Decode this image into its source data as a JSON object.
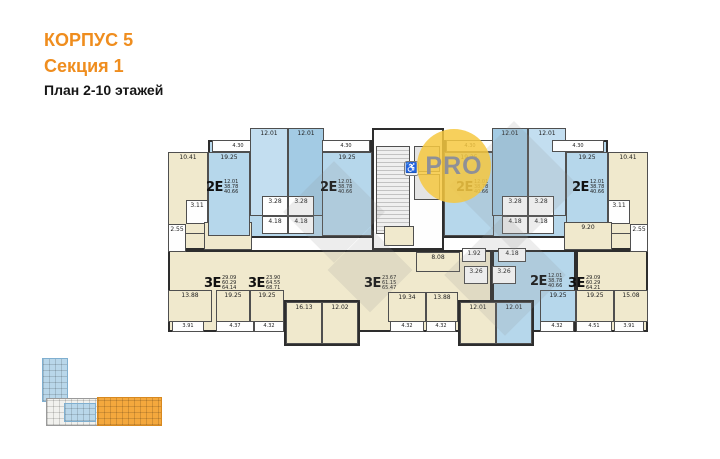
{
  "header": {
    "building": "КОРПУС 5",
    "section": "Секция 1",
    "floor_range": "План 2-10 этажей"
  },
  "badge": {
    "label": "PRO"
  },
  "colors": {
    "accent_orange": "#ef8d1e",
    "title_black": "#161616",
    "apartment_blue": "#b6d7eb",
    "apartment_blue_dark": "#a3cbe4",
    "apartment_beige": "#f0e9cd",
    "wall": "#2d2d2d",
    "badge_yellow": "#f6c83f",
    "badge_text": "#8f9097",
    "minimap_orange": "#f4a83d",
    "minimap_blue": "#b9d7ea"
  },
  "floorplan": {
    "icons": {
      "wheelchair": "♿"
    },
    "apartments": [
      {
        "type": "2Е",
        "areas": [
          "12.01",
          "38.78",
          "40.66"
        ],
        "x": 206,
        "y": 180
      },
      {
        "type": "2Е",
        "areas": [
          "12.01",
          "38.78",
          "40.66"
        ],
        "x": 320,
        "y": 180
      },
      {
        "type": "2Е",
        "areas": [
          "12.01",
          "38.78",
          "40.66"
        ],
        "x": 456,
        "y": 180
      },
      {
        "type": "2Е",
        "areas": [
          "12.01",
          "38.78",
          "40.66"
        ],
        "x": 572,
        "y": 180
      },
      {
        "type": "3Е",
        "areas": [
          "29.09",
          "60.29",
          "64.14"
        ],
        "x": 204,
        "y": 276
      },
      {
        "type": "3Е",
        "areas": [
          "23.90",
          "64.55",
          "68.71"
        ],
        "x": 248,
        "y": 276
      },
      {
        "type": "3Е",
        "areas": [
          "23.67",
          "61.15",
          "65.47"
        ],
        "x": 364,
        "y": 276
      },
      {
        "type": "2Е",
        "areas": [
          "12.01",
          "38.78",
          "40.66"
        ],
        "x": 530,
        "y": 274
      },
      {
        "type": "3Е",
        "areas": [
          "29.09",
          "60.29",
          "64.21"
        ],
        "x": 568,
        "y": 276
      }
    ],
    "cells": [
      {
        "x": 208,
        "y": 140,
        "w": 164,
        "h": 98,
        "f": "blue",
        "k": "backing",
        "n": "apartment-area"
      },
      {
        "x": 444,
        "y": 140,
        "w": 164,
        "h": 98,
        "f": "blue",
        "k": "backing",
        "n": "apartment-area"
      },
      {
        "x": 168,
        "y": 152,
        "w": 40,
        "h": 98,
        "f": "beige",
        "k": "backing",
        "n": "apartment-area"
      },
      {
        "x": 608,
        "y": 152,
        "w": 40,
        "h": 98,
        "f": "beige",
        "k": "backing",
        "n": "apartment-area"
      },
      {
        "x": 168,
        "y": 250,
        "w": 324,
        "h": 82,
        "f": "beige",
        "k": "backing",
        "n": "apartment-area"
      },
      {
        "x": 492,
        "y": 250,
        "w": 84,
        "h": 82,
        "f": "blue",
        "k": "backing",
        "n": "apartment-area"
      },
      {
        "x": 576,
        "y": 250,
        "w": 72,
        "h": 82,
        "f": "beige",
        "k": "backing",
        "n": "apartment-area"
      },
      {
        "x": 284,
        "y": 300,
        "w": 76,
        "h": 46,
        "f": "beige",
        "k": "backing",
        "n": "apartment-area"
      },
      {
        "x": 458,
        "y": 300,
        "w": 38,
        "h": 46,
        "f": "beige",
        "k": "backing",
        "n": "apartment-area"
      },
      {
        "x": 496,
        "y": 300,
        "w": 38,
        "h": 46,
        "f": "blue",
        "k": "backing",
        "n": "apartment-area"
      },
      {
        "x": 372,
        "y": 128,
        "w": 72,
        "h": 122,
        "f": "white",
        "k": "backing",
        "n": "stairwell"
      },
      {
        "x": 168,
        "y": 152,
        "w": 40,
        "h": 82,
        "f": "beige",
        "t": "10.41"
      },
      {
        "x": 186,
        "y": 200,
        "w": 22,
        "h": 24,
        "f": "white",
        "t": "3.11"
      },
      {
        "x": 168,
        "y": 224,
        "w": 18,
        "h": 28,
        "f": "white",
        "t": "2.55"
      },
      {
        "x": 204,
        "y": 222,
        "w": 48,
        "h": 28,
        "f": "beige",
        "t": "9.20"
      },
      {
        "x": 212,
        "y": 140,
        "w": 52,
        "h": 12,
        "f": "white",
        "k": "bal",
        "t": "4.30",
        "n": "balcony"
      },
      {
        "x": 208,
        "y": 152,
        "w": 42,
        "h": 84,
        "f": "blue",
        "t": "19.25"
      },
      {
        "x": 250,
        "y": 128,
        "w": 38,
        "h": 88,
        "f": "blue3",
        "t": "12.01"
      },
      {
        "x": 288,
        "y": 128,
        "w": 36,
        "h": 88,
        "f": "blue2",
        "t": "12.01"
      },
      {
        "x": 322,
        "y": 140,
        "w": 48,
        "h": 12,
        "f": "white",
        "k": "bal",
        "t": "4.30",
        "n": "balcony"
      },
      {
        "x": 322,
        "y": 152,
        "w": 50,
        "h": 84,
        "f": "blue",
        "t": "19.25"
      },
      {
        "x": 262,
        "y": 196,
        "w": 26,
        "h": 20,
        "f": "white",
        "t": "3.28"
      },
      {
        "x": 288,
        "y": 196,
        "w": 26,
        "h": 20,
        "f": "white",
        "t": "3.28"
      },
      {
        "x": 262,
        "y": 216,
        "w": 26,
        "h": 18,
        "f": "white",
        "t": "4.18"
      },
      {
        "x": 288,
        "y": 216,
        "w": 26,
        "h": 18,
        "f": "white",
        "t": "4.18"
      },
      {
        "x": 376,
        "y": 146,
        "w": 34,
        "h": 88,
        "f": "stairs",
        "n": "stairs"
      },
      {
        "x": 414,
        "y": 146,
        "w": 26,
        "h": 26,
        "f": "elev",
        "n": "elevator"
      },
      {
        "x": 414,
        "y": 174,
        "w": 26,
        "h": 26,
        "f": "elev",
        "n": "elevator"
      },
      {
        "x": 384,
        "y": 226,
        "w": 30,
        "h": 20,
        "f": "beige",
        "n": "vestibule"
      },
      {
        "x": 446,
        "y": 140,
        "w": 48,
        "h": 12,
        "f": "white",
        "k": "bal",
        "t": "4.30",
        "n": "balcony"
      },
      {
        "x": 444,
        "y": 152,
        "w": 50,
        "h": 84,
        "f": "blue",
        "t": "19.25"
      },
      {
        "x": 492,
        "y": 128,
        "w": 36,
        "h": 88,
        "f": "blue2",
        "t": "12.01"
      },
      {
        "x": 528,
        "y": 128,
        "w": 38,
        "h": 88,
        "f": "blue3",
        "t": "12.01"
      },
      {
        "x": 552,
        "y": 140,
        "w": 52,
        "h": 12,
        "f": "white",
        "k": "bal",
        "t": "4.30",
        "n": "balcony"
      },
      {
        "x": 566,
        "y": 152,
        "w": 42,
        "h": 84,
        "f": "blue",
        "t": "19.25"
      },
      {
        "x": 608,
        "y": 152,
        "w": 40,
        "h": 82,
        "f": "beige",
        "t": "10.41"
      },
      {
        "x": 608,
        "y": 200,
        "w": 22,
        "h": 24,
        "f": "white",
        "t": "3.11"
      },
      {
        "x": 630,
        "y": 224,
        "w": 18,
        "h": 28,
        "f": "white",
        "t": "2.55"
      },
      {
        "x": 564,
        "y": 222,
        "w": 48,
        "h": 28,
        "f": "beige",
        "t": "9.20"
      },
      {
        "x": 502,
        "y": 196,
        "w": 26,
        "h": 20,
        "f": "white",
        "t": "3.28"
      },
      {
        "x": 528,
        "y": 196,
        "w": 26,
        "h": 20,
        "f": "white",
        "t": "3.28"
      },
      {
        "x": 502,
        "y": 216,
        "w": 26,
        "h": 18,
        "f": "white",
        "t": "4.18"
      },
      {
        "x": 528,
        "y": 216,
        "w": 26,
        "h": 18,
        "f": "white",
        "t": "4.18"
      },
      {
        "x": 168,
        "y": 290,
        "w": 44,
        "h": 32,
        "f": "beige",
        "t": "13.88"
      },
      {
        "x": 216,
        "y": 290,
        "w": 34,
        "h": 32,
        "f": "beige",
        "t": "19.25"
      },
      {
        "x": 250,
        "y": 290,
        "w": 34,
        "h": 32,
        "f": "beige",
        "t": "19.25"
      },
      {
        "x": 172,
        "y": 321,
        "w": 32,
        "h": 11,
        "f": "white",
        "k": "bal",
        "t": "3.91",
        "n": "balcony"
      },
      {
        "x": 216,
        "y": 321,
        "w": 38,
        "h": 11,
        "f": "white",
        "k": "bal",
        "t": "4.37",
        "n": "balcony"
      },
      {
        "x": 254,
        "y": 321,
        "w": 30,
        "h": 11,
        "f": "white",
        "k": "bal",
        "t": "4.32",
        "n": "balcony"
      },
      {
        "x": 286,
        "y": 302,
        "w": 36,
        "h": 42,
        "f": "beige",
        "t": "16.13"
      },
      {
        "x": 322,
        "y": 302,
        "w": 36,
        "h": 42,
        "f": "beige",
        "t": "12.02"
      },
      {
        "x": 416,
        "y": 252,
        "w": 44,
        "h": 20,
        "f": "beige",
        "t": "8.08"
      },
      {
        "x": 462,
        "y": 248,
        "w": 24,
        "h": 14,
        "f": "white",
        "t": "1.92"
      },
      {
        "x": 498,
        "y": 248,
        "w": 28,
        "h": 14,
        "f": "white",
        "t": "4.18"
      },
      {
        "x": 464,
        "y": 266,
        "w": 24,
        "h": 18,
        "f": "white",
        "t": "3.26"
      },
      {
        "x": 492,
        "y": 266,
        "w": 24,
        "h": 18,
        "f": "white",
        "t": "3.26"
      },
      {
        "x": 388,
        "y": 292,
        "w": 38,
        "h": 30,
        "f": "beige",
        "t": "19.34"
      },
      {
        "x": 426,
        "y": 292,
        "w": 32,
        "h": 30,
        "f": "beige",
        "t": "13.88"
      },
      {
        "x": 390,
        "y": 321,
        "w": 34,
        "h": 11,
        "f": "white",
        "k": "bal",
        "t": "4.32",
        "n": "balcony"
      },
      {
        "x": 426,
        "y": 321,
        "w": 30,
        "h": 11,
        "f": "white",
        "k": "bal",
        "t": "4.32",
        "n": "balcony"
      },
      {
        "x": 460,
        "y": 302,
        "w": 36,
        "h": 42,
        "f": "beige",
        "t": "12.01"
      },
      {
        "x": 496,
        "y": 302,
        "w": 36,
        "h": 42,
        "f": "blue",
        "t": "12.01"
      },
      {
        "x": 540,
        "y": 290,
        "w": 36,
        "h": 32,
        "f": "blue",
        "t": "19.25"
      },
      {
        "x": 540,
        "y": 321,
        "w": 34,
        "h": 11,
        "f": "white",
        "k": "bal",
        "t": "4.32",
        "n": "balcony"
      },
      {
        "x": 576,
        "y": 290,
        "w": 38,
        "h": 32,
        "f": "beige",
        "t": "19.25"
      },
      {
        "x": 614,
        "y": 290,
        "w": 34,
        "h": 32,
        "f": "beige",
        "t": "15.08"
      },
      {
        "x": 576,
        "y": 321,
        "w": 36,
        "h": 11,
        "f": "white",
        "k": "bal",
        "t": "4.51",
        "n": "balcony"
      },
      {
        "x": 614,
        "y": 321,
        "w": 30,
        "h": 11,
        "f": "white",
        "k": "bal",
        "t": "3.91",
        "n": "balcony"
      }
    ]
  },
  "watermarks": {
    "diamonds": [
      {
        "x": 298,
        "y": 176,
        "s": 72
      },
      {
        "x": 468,
        "y": 140,
        "s": 92
      },
      {
        "x": 462,
        "y": 232,
        "s": 86
      },
      {
        "x": 340,
        "y": 240,
        "s": 60
      }
    ]
  },
  "minimap": {
    "blocks": [
      {
        "x": 42,
        "y": 358,
        "w": 26,
        "h": 44,
        "c": "mblue",
        "n": "other-section-wing"
      },
      {
        "x": 46,
        "y": 398,
        "w": 52,
        "h": 28,
        "c": "mwhite",
        "n": "other-section-wing"
      },
      {
        "x": 64,
        "y": 403,
        "w": 32,
        "h": 19,
        "c": "mblue",
        "n": "other-section-wing"
      },
      {
        "x": 97,
        "y": 397,
        "w": 65,
        "h": 29,
        "c": "morange",
        "n": "current-section-highlight"
      }
    ]
  }
}
